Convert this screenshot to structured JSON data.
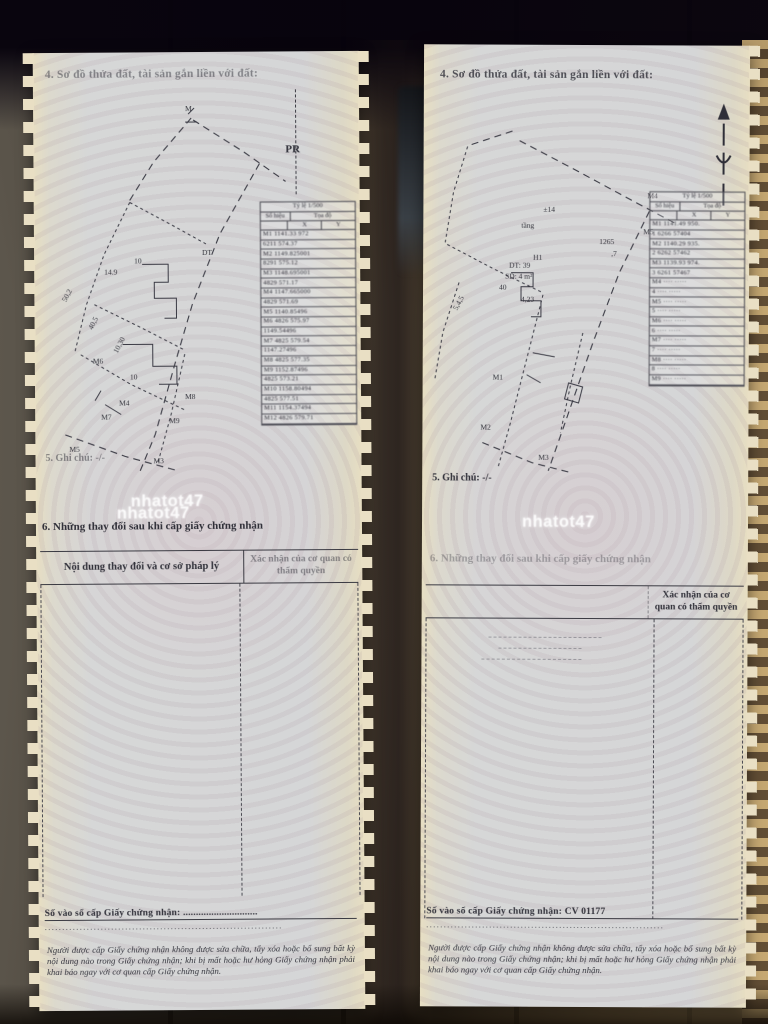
{
  "photo": {
    "watermark": "nhatot47",
    "colors": {
      "wood_dark": "#2c231b",
      "wood_mid": "#6e665a",
      "wood_light": "#c9ab74",
      "page_paper": "#d5d6d7",
      "page_edge": "#e7dec2",
      "ink": "#2f2f38",
      "watermark_color": "#ffffff"
    }
  },
  "doc": {
    "section4_title": "4. Sơ đồ thửa đất, tài sản gắn liền với đất:",
    "section5_note": "5. Ghi chú: -/-",
    "section6_title": "6. Những thay đổi sau khi cấp giấy chứng nhận",
    "change_table": {
      "col_content": "Nội dung thay đổi và cơ sở pháp lý",
      "col_confirm": "Xác nhận của cơ quan có thẩm quyền"
    },
    "legal_note": "Người được cấp Giấy chứng nhận không được sửa chữa, tẩy xóa hoặc bổ sung bất kỳ nội dung nào trong Giấy chứng nhận; khi bị mất hoặc hư hỏng Giấy chứng nhận phải khai báo ngay với cơ quan cấp Giấy chứng nhận."
  },
  "pages": {
    "left": {
      "road_label": "PR",
      "top_point_label": "M",
      "serial_line": "Số vào sổ cấp Giấy chứng nhận: .............................",
      "dots": "....................................................................",
      "coord_table": {
        "title": "Tỷ lệ 1/500",
        "header_point": "Số hiệu",
        "header_coord": "Tọa độ",
        "col_x": "X",
        "col_y": "Y",
        "rows": [
          "M1  1141.33  972",
          "6211  574.37",
          "M2  1149.825001",
          "8291  575.12",
          "M3  1148.695001",
          "4829  571.17",
          "M4  1147.665000",
          "4829  571.69",
          "M5  1140.85496",
          "M6  4826  575.97",
          "1149.54496",
          "M7  4825  579.54",
          "1147.27496",
          "M8  4825  577.35",
          "M9  1152.87496",
          "4825  573.21",
          "M10  1158.80494",
          "4825  577.51",
          "M11  1154.37494",
          "M12  4826  579.71"
        ]
      },
      "diagram_labels": [
        {
          "t": "M",
          "x": 152,
          "y": 0
        },
        {
          "t": "DT",
          "x": 168,
          "y": 144
        },
        {
          "t": "10",
          "x": 100,
          "y": 152
        },
        {
          "t": "14.9",
          "x": 70,
          "y": 163
        },
        {
          "t": "50,2",
          "x": 26,
          "y": 186,
          "r": -62
        },
        {
          "t": "40,5",
          "x": 52,
          "y": 214,
          "r": -62
        },
        {
          "t": "10,30",
          "x": 76,
          "y": 236,
          "r": -62
        },
        {
          "t": "M6",
          "x": 58,
          "y": 252
        },
        {
          "t": "10",
          "x": 95,
          "y": 268
        },
        {
          "t": "M4",
          "x": 84,
          "y": 294
        },
        {
          "t": "M7",
          "x": 66,
          "y": 308
        },
        {
          "t": "M8",
          "x": 150,
          "y": 288
        },
        {
          "t": "M9",
          "x": 134,
          "y": 312
        },
        {
          "t": "M5",
          "x": 34,
          "y": 340
        },
        {
          "t": "M3",
          "x": 118,
          "y": 352
        }
      ]
    },
    "right": {
      "road_label": "",
      "top_point_label": "",
      "serial_line": "Số vào sổ cấp Giấy chứng nhận: CV 01177",
      "dots": "....................................................................",
      "coord_table": {
        "title": "Tỷ lệ 1/500",
        "header_point": "Số hiệu",
        "header_coord": "Tọa độ",
        "col_x": "X",
        "col_y": "Y",
        "rows": [
          "M1  1141.49  950.",
          "1  6266  57404",
          "M2  1140.29  935.",
          "2  6262  57462",
          "M3  1139.93  974.",
          "3  6261  57467",
          "M4  ····  ·····",
          "4  ····  ·····",
          "M5  ····  ·····",
          "5  ····  ·····",
          "M6  ····  ·····",
          "6  ····  ·····",
          "M7  ····  ·····",
          "7  ····  ·····",
          "M8  ····  ·····",
          "8  ····  ·····",
          "M9  ····  ·····"
        ]
      },
      "diagram_labels": [
        {
          "t": "±14",
          "x": 120,
          "y": 82
        },
        {
          "t": "tầng",
          "x": 98,
          "y": 98
        },
        {
          "t": "M4",
          "x": 224,
          "y": 68
        },
        {
          "t": "M5",
          "x": 220,
          "y": 104
        },
        {
          "t": "H1",
          "x": 110,
          "y": 130
        },
        {
          "t": "1265",
          "x": 176,
          "y": 114
        },
        {
          "t": ",7",
          "x": 188,
          "y": 126
        },
        {
          "t": "DT: 39",
          "x": 86,
          "y": 138
        },
        {
          "t": "SD: 4 m²",
          "x": 82,
          "y": 149
        },
        {
          "t": "40",
          "x": 76,
          "y": 160
        },
        {
          "t": "4,23",
          "x": 98,
          "y": 172
        },
        {
          "t": "5,4,5",
          "x": 28,
          "y": 176,
          "r": -62
        },
        {
          "t": "M1",
          "x": 70,
          "y": 250
        },
        {
          "t": "M2",
          "x": 58,
          "y": 300
        },
        {
          "t": "M3",
          "x": 116,
          "y": 330
        }
      ]
    }
  }
}
